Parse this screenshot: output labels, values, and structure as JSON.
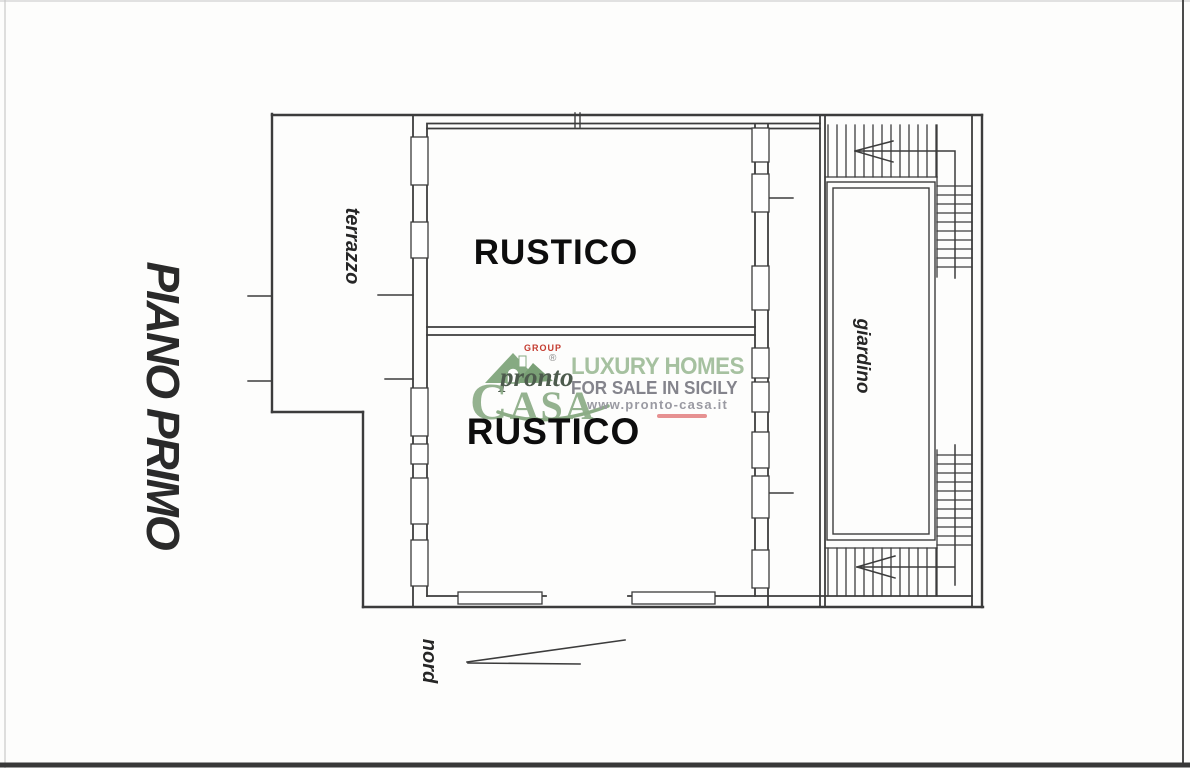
{
  "plan": {
    "floor_title": "PIANO PRIMO",
    "labels": {
      "terrace": "terrazzo",
      "room_upper": "RUSTICO",
      "room_lower": "RUSTICO",
      "garden": "giardino",
      "north": "nord"
    },
    "ink_color": "#3c3c3c"
  },
  "watermark": {
    "group_label": "GROUP",
    "registered_mark": "®",
    "brand_script": "pronto",
    "brand_initial": "C",
    "brand_rest": "ASA",
    "tagline_line1": "LUXURY HOMES",
    "tagline_line2": "FOR SALE IN SICILY",
    "website": "www.pronto-casa.it",
    "colors": {
      "brand_green": "#8cac86",
      "tagline_green": "#a6c1a0",
      "group_red": "#c43c30",
      "tagline_gray": "#84848c",
      "underline_pink": "#e69191"
    }
  }
}
